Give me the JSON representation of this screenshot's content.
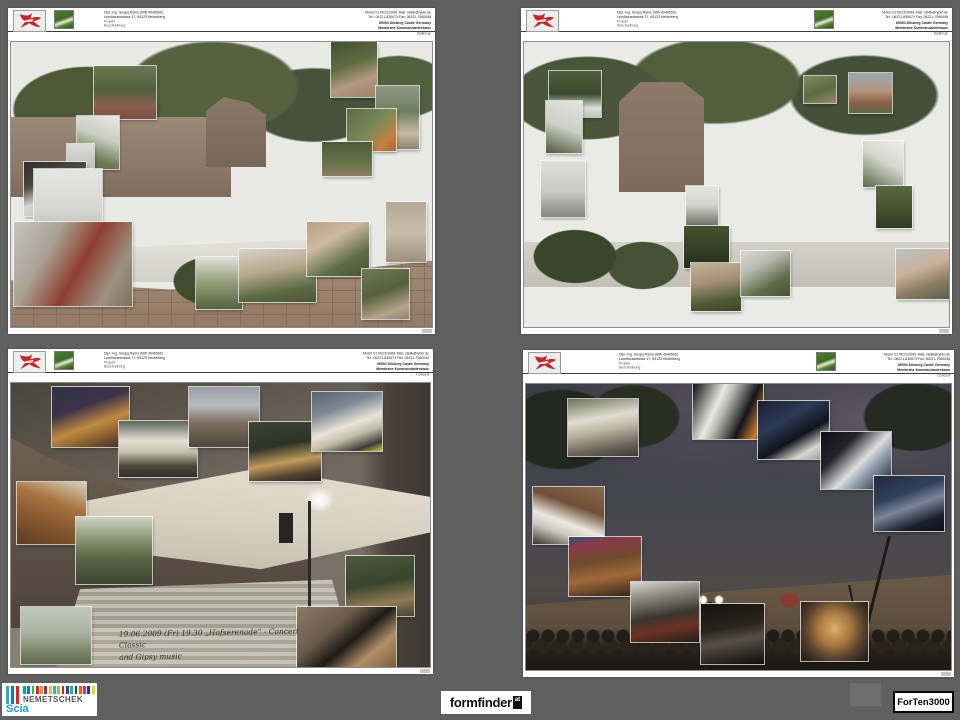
{
  "window": {
    "background_color": "#606060"
  },
  "sheet_header": {
    "owner_line1": "Dipl.-Ing. Sergej Rybin (MW 4046500)",
    "owner_line2": "Landhausstrasse 17, 69123 Heidelberg",
    "owner_line3": "Projekt",
    "owner_line4": "Beschreibung",
    "contact_line1": "Mobil: 0176/2319981   Mail: statik@rybin.de",
    "contact_line2": "Tel.: 06221-830673   Fax: 06221-7960046",
    "site_line1": "69094 Dilsberg Castle Germany",
    "site_line2": "Membrane Kommandantenhaus",
    "logo_color": "#c1272d"
  },
  "sheets": [
    {
      "title": "Build up"
    },
    {
      "title": "Build up"
    },
    {
      "title": "Concert",
      "caption": [
        "19.06.2009 (Fr) 19.30 „Hofserenade“ - Concert Classic",
        "and Gipsy music"
      ]
    },
    {
      "title": "Concert"
    }
  ],
  "footer_logos": {
    "nemetschek": {
      "brand": "NEMETSCHEK",
      "product": "Scia",
      "tall_bar_colors": [
        "#29abe2",
        "#1b75bb",
        "#ed1c24"
      ],
      "small_bar_colors": [
        "#00a99d",
        "#1b75bc",
        "#39b54a",
        "#ed1c24",
        "#f7931e",
        "#93278f",
        "#fbb03b",
        "#29abe2",
        "#8dc63f",
        "#c1272d",
        "#662d91",
        "#00aeef",
        "#006837",
        "#f15a24",
        "#ed1e79",
        "#2e3192",
        "#d9e021"
      ]
    },
    "formfinder": {
      "brand": "formfinder",
      "suffix": "at"
    },
    "forten3000": {
      "brand": "ForTen3000"
    }
  }
}
